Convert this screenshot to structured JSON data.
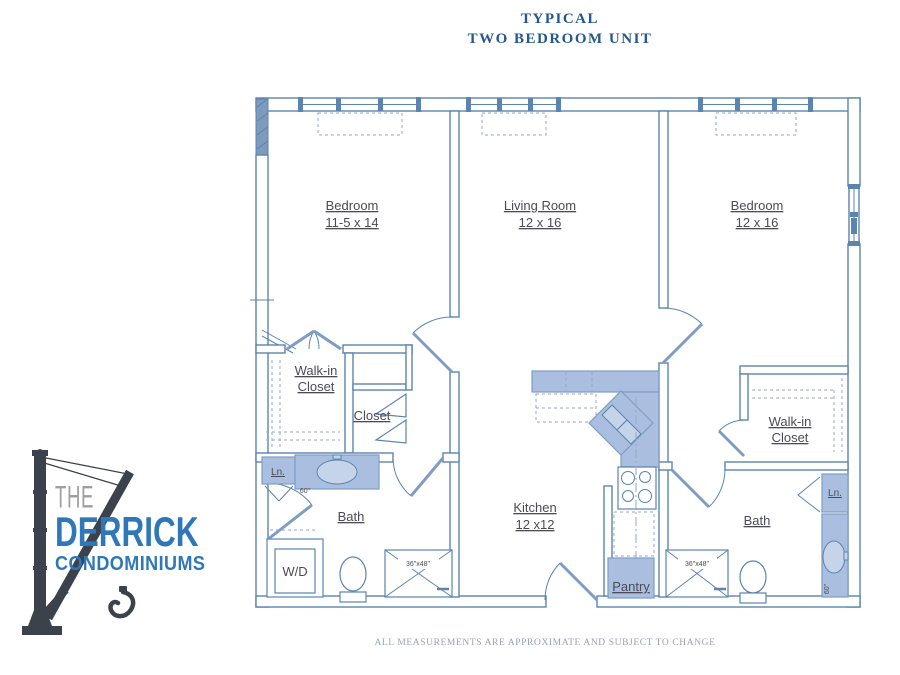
{
  "title": {
    "line1": "TYPICAL",
    "line2": "TWO BEDROOM UNIT"
  },
  "disclaimer": {
    "text": "ALL MEASUREMENTS ARE APPROXIMATE AND SUBJECT TO CHANGE"
  },
  "logo": {
    "the": "THE",
    "derrick": "DERRICK",
    "condominiums": "CONDOMINIUMS"
  },
  "rooms": {
    "bedroom_left": {
      "name": "Bedroom",
      "dims": "11-5 x 14"
    },
    "living_room": {
      "name": "Living Room",
      "dims": "12 x 16"
    },
    "bedroom_right": {
      "name": "Bedroom",
      "dims": "12 x 16"
    },
    "walk_in_left": {
      "line1": "Walk-in",
      "line2": "Closet"
    },
    "walk_in_right": {
      "line1": "Walk-in",
      "line2": "Closet"
    },
    "closet": {
      "name": "Closet"
    },
    "linen_left": {
      "name": "Ln."
    },
    "linen_right": {
      "name": "Ln."
    },
    "bath_left": {
      "name": "Bath"
    },
    "bath_right": {
      "name": "Bath"
    },
    "washer_dryer": {
      "name": "W/D"
    },
    "kitchen": {
      "name": "Kitchen",
      "dims": "12 x12"
    },
    "pantry": {
      "name": "Pantry"
    },
    "shower_left": {
      "dims": "36\"x48\""
    },
    "shower_right": {
      "dims": "36\"x48\""
    },
    "vanity_left": {
      "dims": "60\""
    },
    "vanity_right": {
      "dims": "60\""
    }
  },
  "colors": {
    "wall": "#5b84ae",
    "fixture": "#aabfe0",
    "fixture_dark": "#7f9cc4",
    "dash": "#98a7c0",
    "label": "#4b4b55",
    "title": "#24578c",
    "disclaimer": "#95a3b3",
    "logo_blue": "#2e77b8",
    "logo_gray": "#9e9e9e",
    "crane": "#3b424c"
  }
}
